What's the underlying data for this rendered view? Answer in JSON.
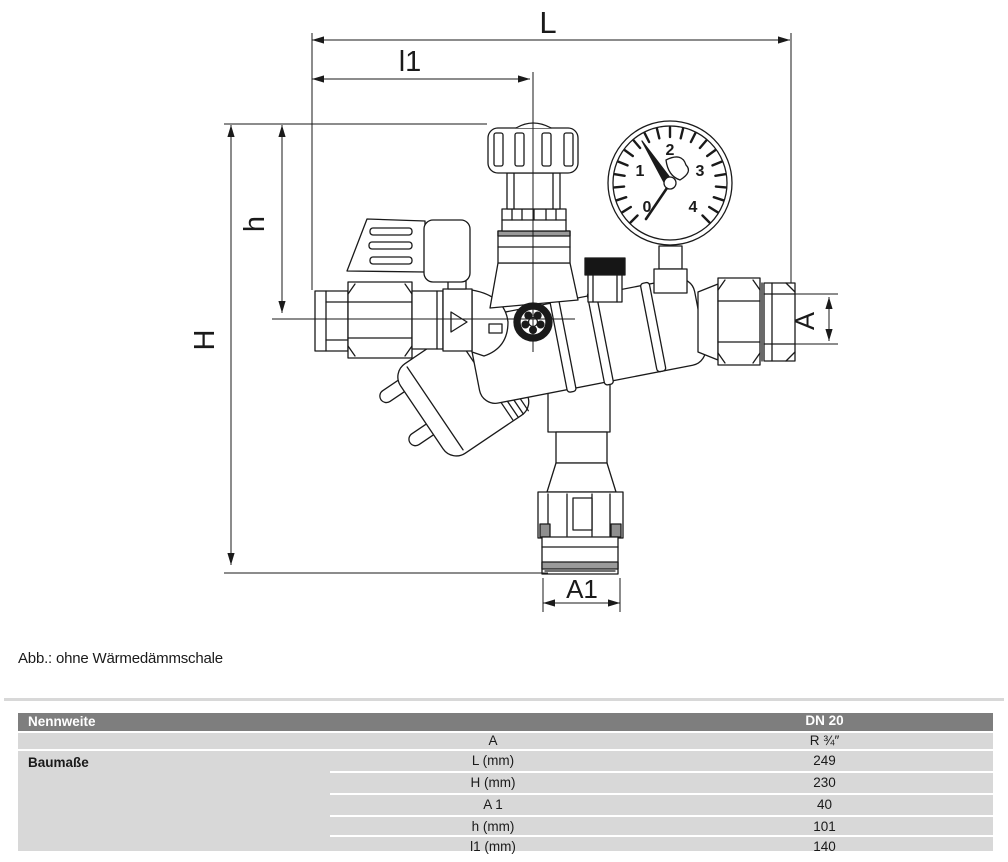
{
  "drawing": {
    "dim_labels": {
      "L": "L",
      "l1": "l1",
      "h": "h",
      "H": "H",
      "A": "A",
      "A1": "A1"
    },
    "gauge_numbers": [
      "0",
      "1",
      "2",
      "3",
      "4"
    ],
    "line_color": "#1a1a1a"
  },
  "caption": "Abb.: ohne Wärmedämmschale",
  "table": {
    "colors": {
      "header_bg": "#7e7e7e",
      "header_text": "#ffffff",
      "row_bg": "#d8d8d8"
    },
    "header": {
      "label": "Nennweite",
      "value": "DN 20"
    },
    "row_a": {
      "param": "A",
      "value": "R ¾″"
    },
    "group_label": "Baumaße",
    "rows": [
      {
        "param": "L (mm)",
        "value": "249"
      },
      {
        "param": "H (mm)",
        "value": "230"
      },
      {
        "param": "A 1",
        "value": "40"
      },
      {
        "param": "h (mm)",
        "value": "101"
      },
      {
        "param": "l1 (mm)",
        "value": "140"
      }
    ]
  }
}
